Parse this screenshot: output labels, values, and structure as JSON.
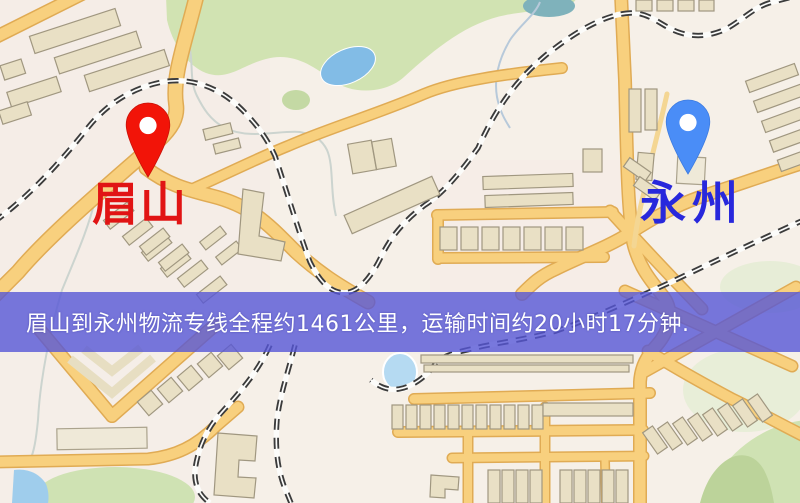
{
  "banner": {
    "text": "眉山到永州物流专线全程约1461公里，运输时间约20小时17分钟.",
    "bg_color": "#5656d6",
    "text_color": "#ffffff"
  },
  "markers": {
    "origin": {
      "label": "眉山",
      "label_color": "#e11414",
      "pin_color": "#f21408"
    },
    "destination": {
      "label": "永州",
      "label_color": "#2828dc",
      "pin_color": "#4a8df7"
    }
  },
  "route": {
    "from": "眉山",
    "to": "永州",
    "distance_text": "约1461公里",
    "duration_text": "约20小时17分钟"
  }
}
